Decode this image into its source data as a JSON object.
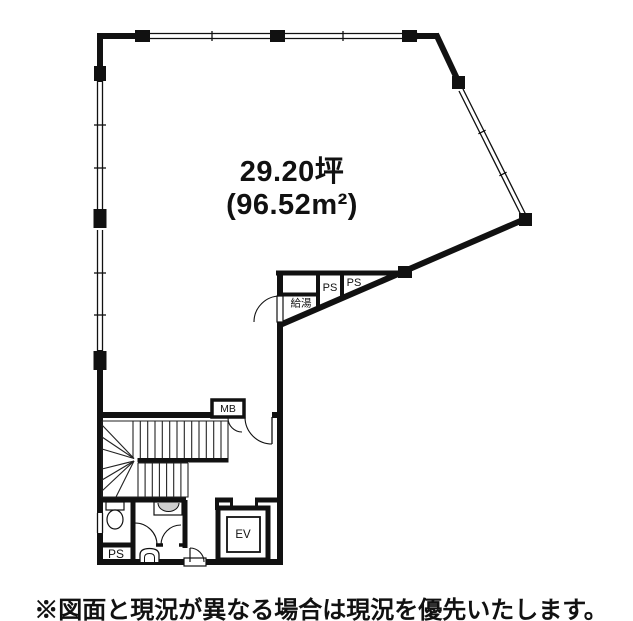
{
  "colors": {
    "line": "#111111",
    "background": "#ffffff",
    "fixture_fill": "#cfcfcf"
  },
  "plan": {
    "area_line1": "29.20坪",
    "area_line2": "(96.52m²)",
    "rooms": {
      "kyuto_label": "給湯",
      "ps_upper_1": "PS",
      "ps_upper_2": "PS",
      "mb_label": "MB",
      "ev_label": "EV",
      "ps_lower": "PS"
    },
    "caption": "※図面と現況が異なる場合は現況を優先いたします。"
  }
}
